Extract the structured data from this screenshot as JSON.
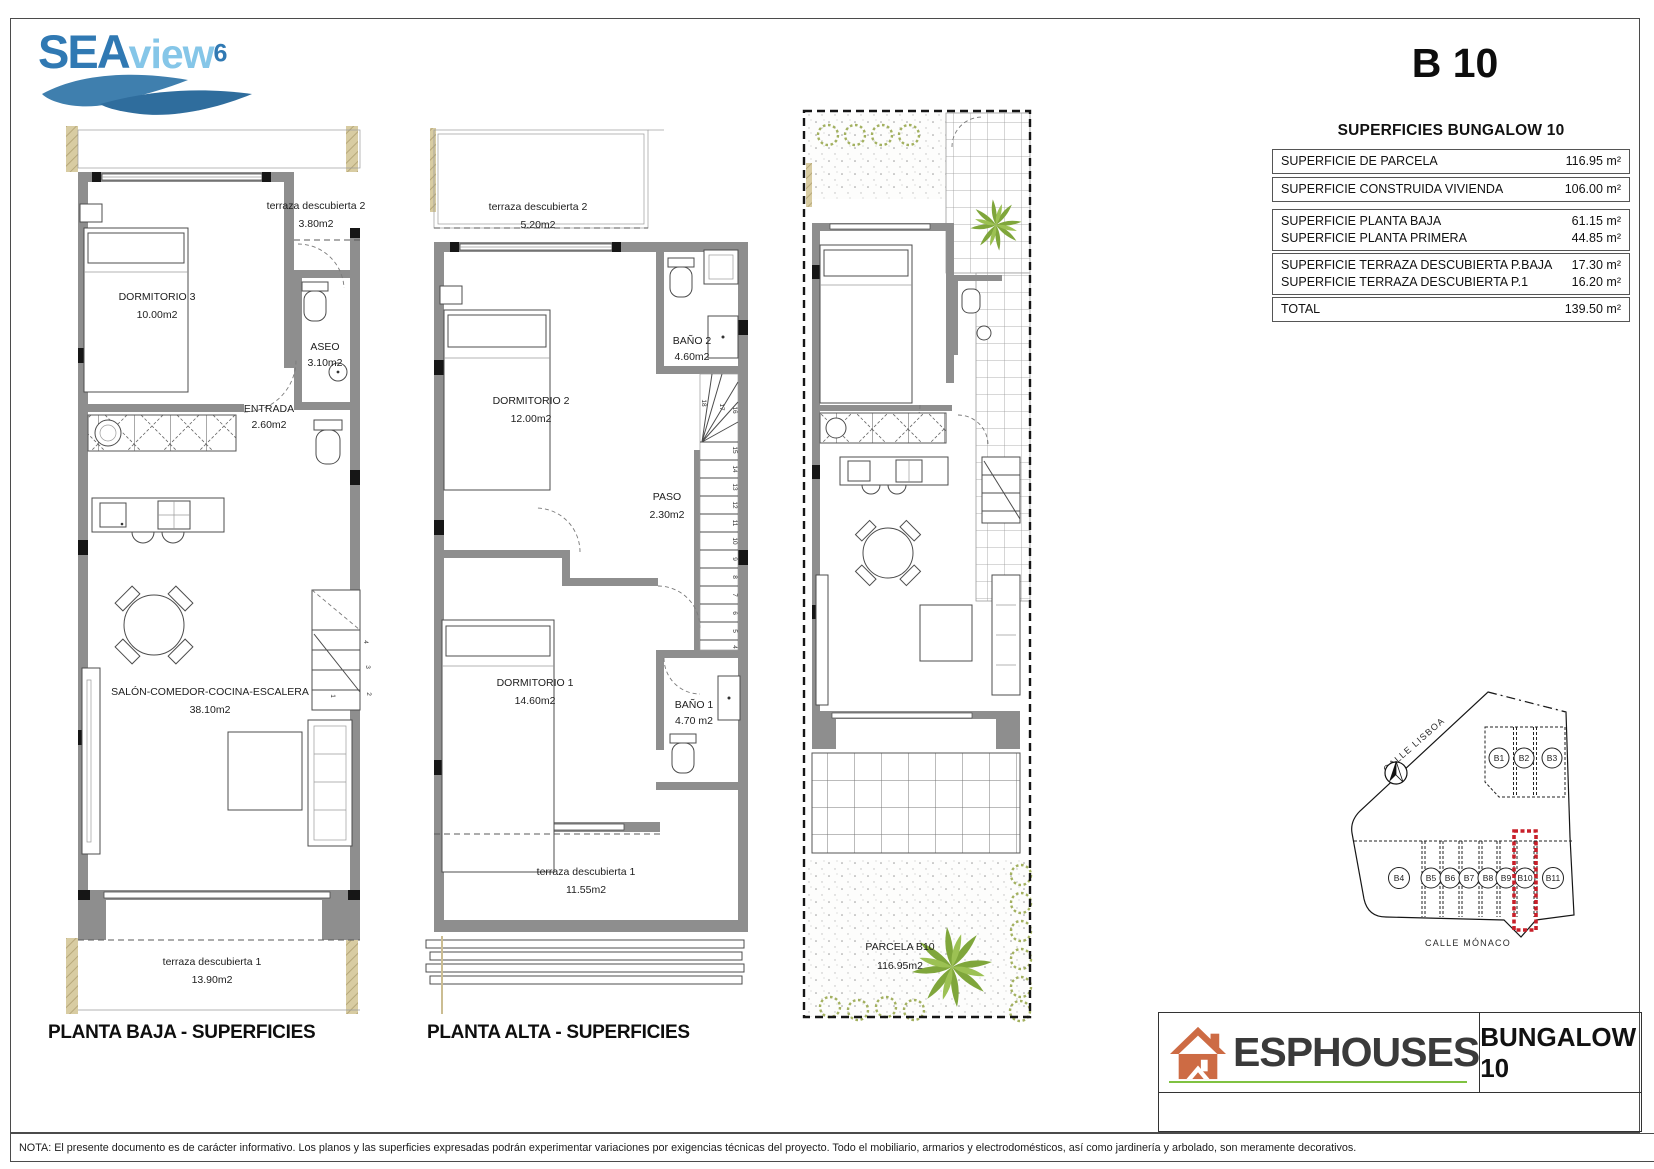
{
  "header": {
    "logo": {
      "part1": "SEA",
      "part2": "view",
      "sup": "6"
    },
    "unit_code": "B 10"
  },
  "surfaces": {
    "title": "SUPERFICIES BUNGALOW 10",
    "rows": [
      {
        "label": "SUPERFICIE DE PARCELA",
        "value": "116.95 m²"
      },
      {
        "label": "SUPERFICIE CONSTRUIDA VIVIENDA",
        "value": "106.00 m²"
      },
      {
        "label": "SUPERFICIE PLANTA BAJA",
        "value": "61.15 m²"
      },
      {
        "label": "SUPERFICIE PLANTA PRIMERA",
        "value": "44.85 m²"
      },
      {
        "label": "SUPERFICIE TERRAZA DESCUBIERTA P.BAJA",
        "value": "17.30 m²"
      },
      {
        "label": "SUPERFICIE TERRAZA DESCUBIERTA P.1",
        "value": "16.20 m²"
      },
      {
        "label": "TOTAL",
        "value": "139.50 m²"
      }
    ]
  },
  "planta_baja": {
    "caption": "PLANTA BAJA - SUPERFICIES",
    "rooms": {
      "terraza2": {
        "name": "terraza descubierta 2",
        "area": "3.80m2"
      },
      "dormitorio3": {
        "name": "DORMITORIO 3",
        "area": "10.00m2"
      },
      "aseo": {
        "name": "ASEO",
        "area": "3.10m2"
      },
      "entrada": {
        "name": "ENTRADA",
        "area": "2.60m2"
      },
      "salon": {
        "name": "SALÓN-COMEDOR-COCINA-ESCALERA",
        "area": "38.10m2"
      },
      "terraza1": {
        "name": "terraza descubierta 1",
        "area": "13.90m2"
      }
    },
    "stairs": [
      "1",
      "2",
      "3",
      "4"
    ]
  },
  "planta_alta": {
    "caption": "PLANTA ALTA - SUPERFICIES",
    "rooms": {
      "terraza2": {
        "name": "terraza descubierta 2",
        "area": "5.20m2"
      },
      "dormitorio2": {
        "name": "DORMITORIO 2",
        "area": "12.00m2"
      },
      "bano2": {
        "name": "BAÑO 2",
        "area": "4.60m2"
      },
      "paso": {
        "name": "PASO",
        "area": "2.30m2"
      },
      "dormitorio1": {
        "name": "DORMITORIO 1",
        "area": "14.60m2"
      },
      "bano1": {
        "name": "BAÑO 1",
        "area": "4.70 m2"
      },
      "terraza1": {
        "name": "terraza descubierta 1",
        "area": "11.55m2"
      }
    },
    "stairs": [
      "4",
      "5",
      "6",
      "7",
      "8",
      "9",
      "10",
      "11",
      "12",
      "13",
      "14",
      "15",
      "16",
      "17",
      "18"
    ]
  },
  "parcela": {
    "name": "PARCELA B10",
    "area": "116.95m2"
  },
  "site_map": {
    "street_top": "CALLE LISBOA",
    "street_bottom": "CALLE MÓNACO",
    "plots": [
      "B1",
      "B2",
      "B3",
      "B4",
      "B5",
      "B6",
      "B7",
      "B8",
      "B9",
      "B10",
      "B11"
    ],
    "highlighted_plot": "B10",
    "highlight_color": "#c8202a"
  },
  "footer": {
    "brand": "ESPHOUSES",
    "unit_label": "BUNGALOW 10",
    "note": "NOTA: El presente documento es de carácter informativo. Los planos y las superficies expresadas podrán experimentar variaciones por exigencias técnicas del proyecto. Todo el mobiliario, armarios y electrodomésticos, así como jardinería y arbolado, son meramente decorativos."
  },
  "colors": {
    "logo_dark_blue": "#3079b3",
    "logo_light_blue": "#85c6e8",
    "wall_gray": "#8e8e8e",
    "hatch_tan": "#d8cca2",
    "plant_green": "#7fa63b",
    "highlight_red": "#c8202a",
    "brand_orange": "#cd6b44",
    "brand_green": "#7fc241"
  }
}
